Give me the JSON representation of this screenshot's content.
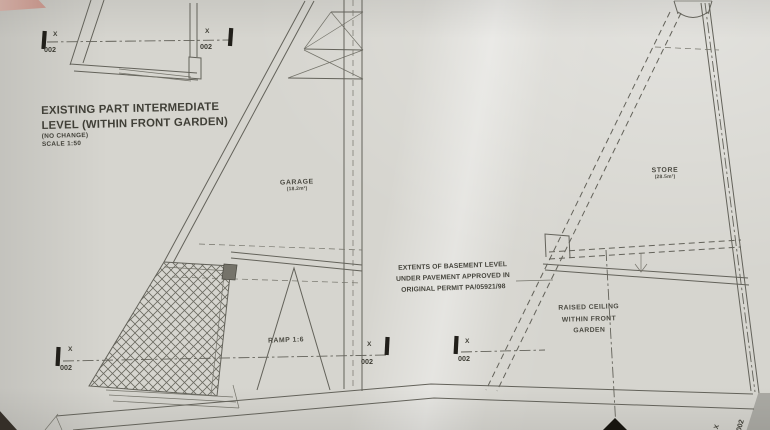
{
  "colors": {
    "paper": "#d6d5cf",
    "line": "#63625a",
    "ink": "#45443c",
    "marker_bar": "#211f1a",
    "background_corner_pink": "#c6a198",
    "background_shadow": "#352f28"
  },
  "title_block": {
    "line1": "EXISTING PART INTERMEDIATE",
    "line2": "LEVEL (WITHIN FRONT GARDEN)",
    "note": "(NO CHANGE)",
    "scale": "SCALE 1:50"
  },
  "section_marker": {
    "letter": "X",
    "sheet": "002"
  },
  "left_plan": {
    "room": {
      "name": "GARAGE",
      "area": "(18.2m²)"
    },
    "ramp": "RAMP 1:6"
  },
  "right_plan": {
    "room": {
      "name": "STORE",
      "area": "(28.5m²)"
    },
    "raised_ceiling": {
      "line1": "RAISED CEILING",
      "line2": "WITHIN FRONT",
      "line3": "GARDEN"
    }
  },
  "annotation": {
    "line1": "EXTENTS OF BASEMENT LEVEL",
    "line2": "UNDER PAVEMENT APPROVED IN",
    "line3": "ORIGINAL PERMIT PA/05921/98"
  }
}
